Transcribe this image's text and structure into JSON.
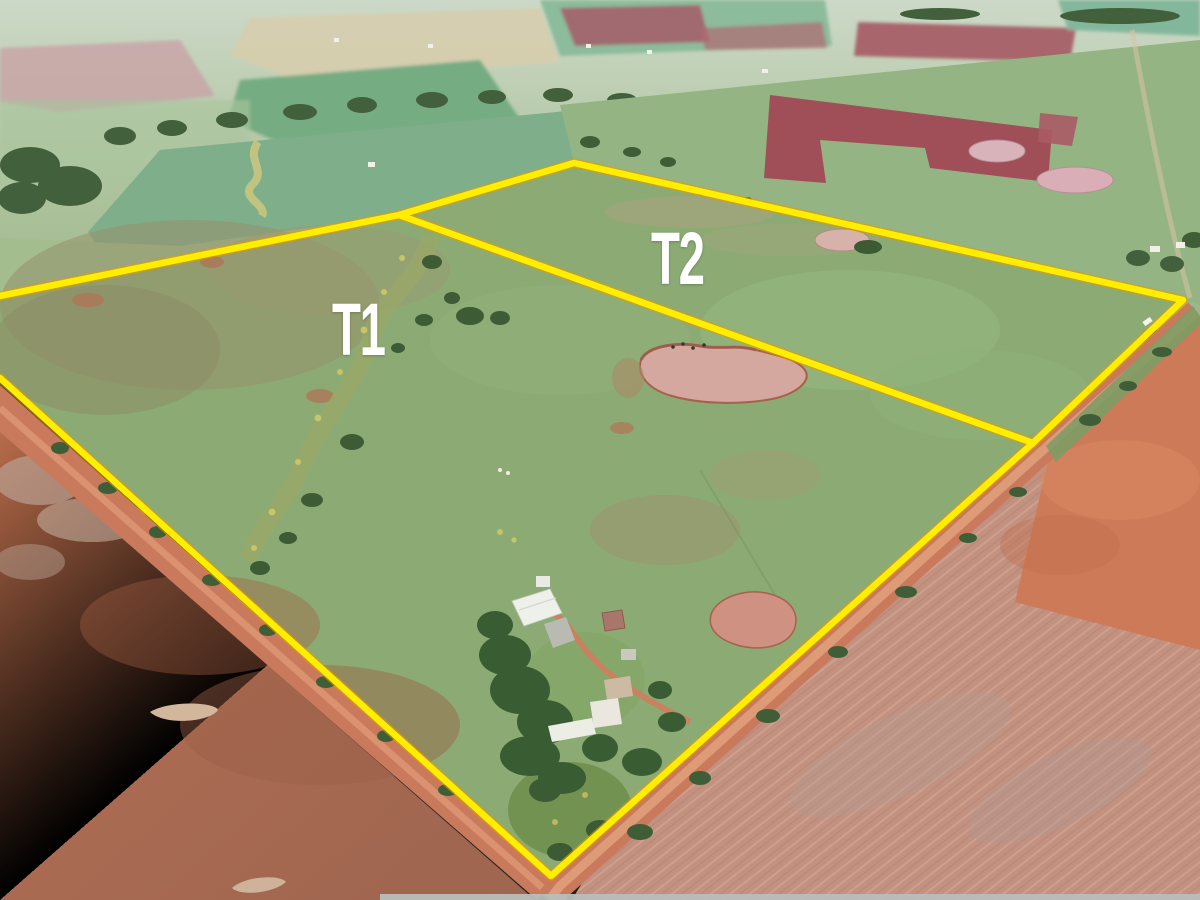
{
  "tracts": [
    {
      "label": "T1"
    },
    {
      "label": "T2"
    }
  ],
  "overlay": {
    "boundary_color": "#ffee00",
    "halo_color": "#e29c00",
    "label_color": "#ffffff"
  }
}
